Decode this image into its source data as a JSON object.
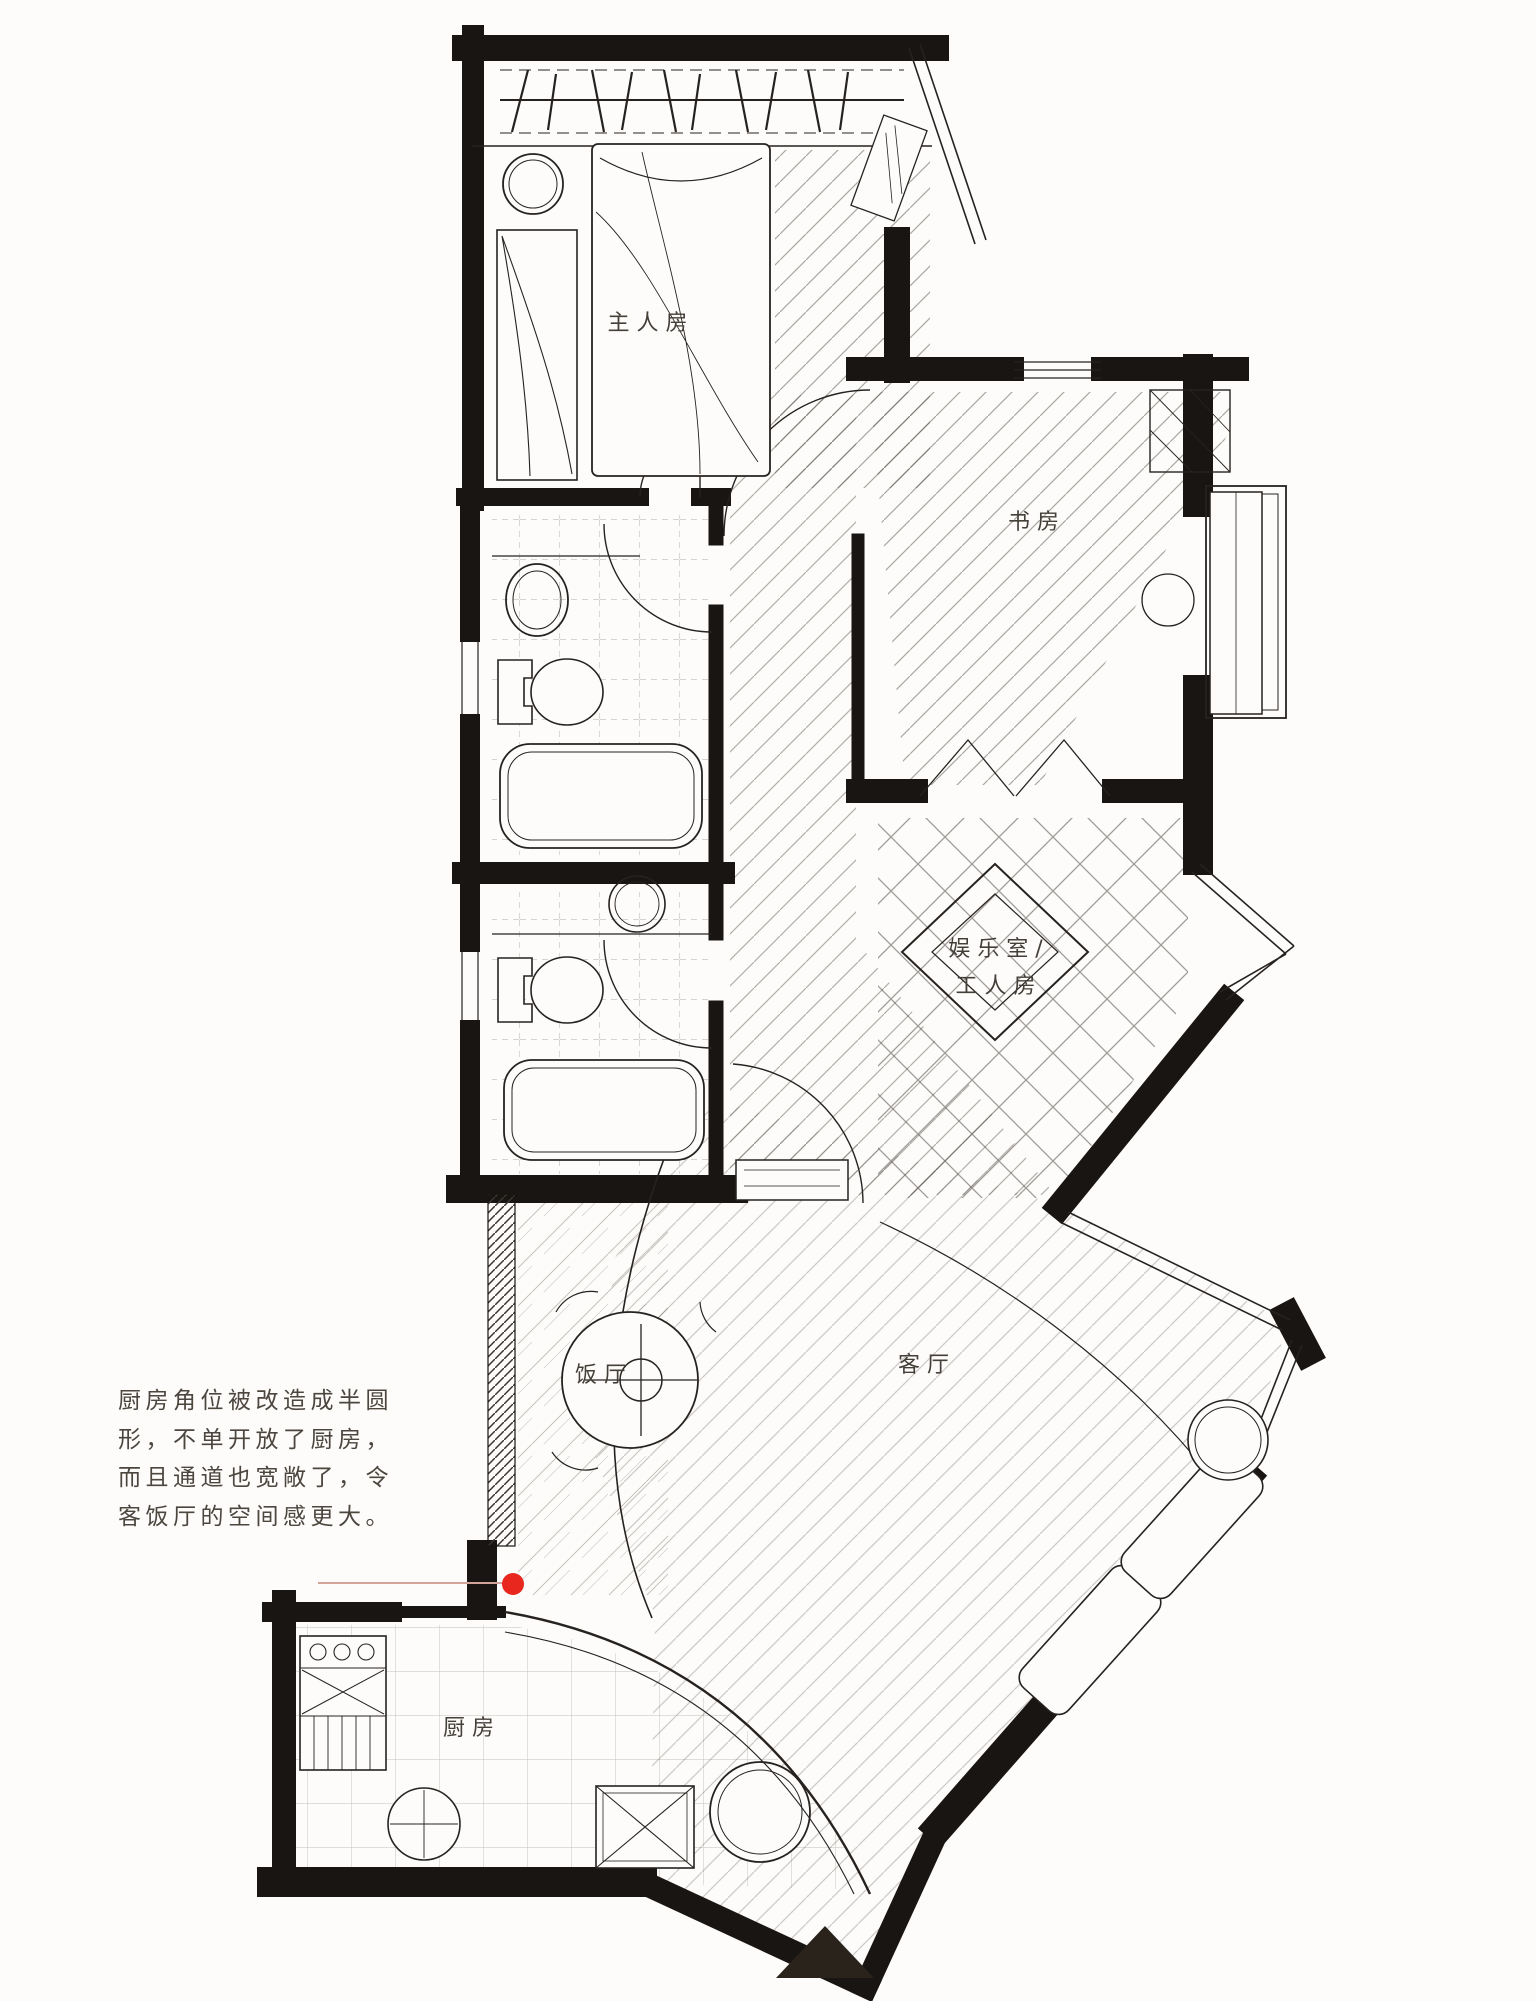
{
  "page": {
    "title": "open-kitchen floor plan sketch",
    "paper_color": "#fdfcfa",
    "ink_color": "#181512"
  },
  "floor_plan": {
    "rooms": [
      {
        "id": "master-bedroom",
        "label": "主人房"
      },
      {
        "id": "study",
        "label": "书房"
      },
      {
        "id": "entertainment-worker-room",
        "label_line1": "娱乐室/",
        "label_line2": "工人房"
      },
      {
        "id": "dining-room",
        "label": "饭厅"
      },
      {
        "id": "living-room",
        "label": "客厅"
      },
      {
        "id": "kitchen",
        "label": "厨房"
      }
    ]
  },
  "caption": {
    "lines": [
      "厨房角位被改造成半圆",
      "形，不单开放了厨房，",
      "而且通道也宽敞了，令",
      "客饭厅的空间感更大。"
    ],
    "marker_color": "#e8281e"
  },
  "page_marker": {
    "shape": "triangle",
    "color": "#29231c"
  }
}
